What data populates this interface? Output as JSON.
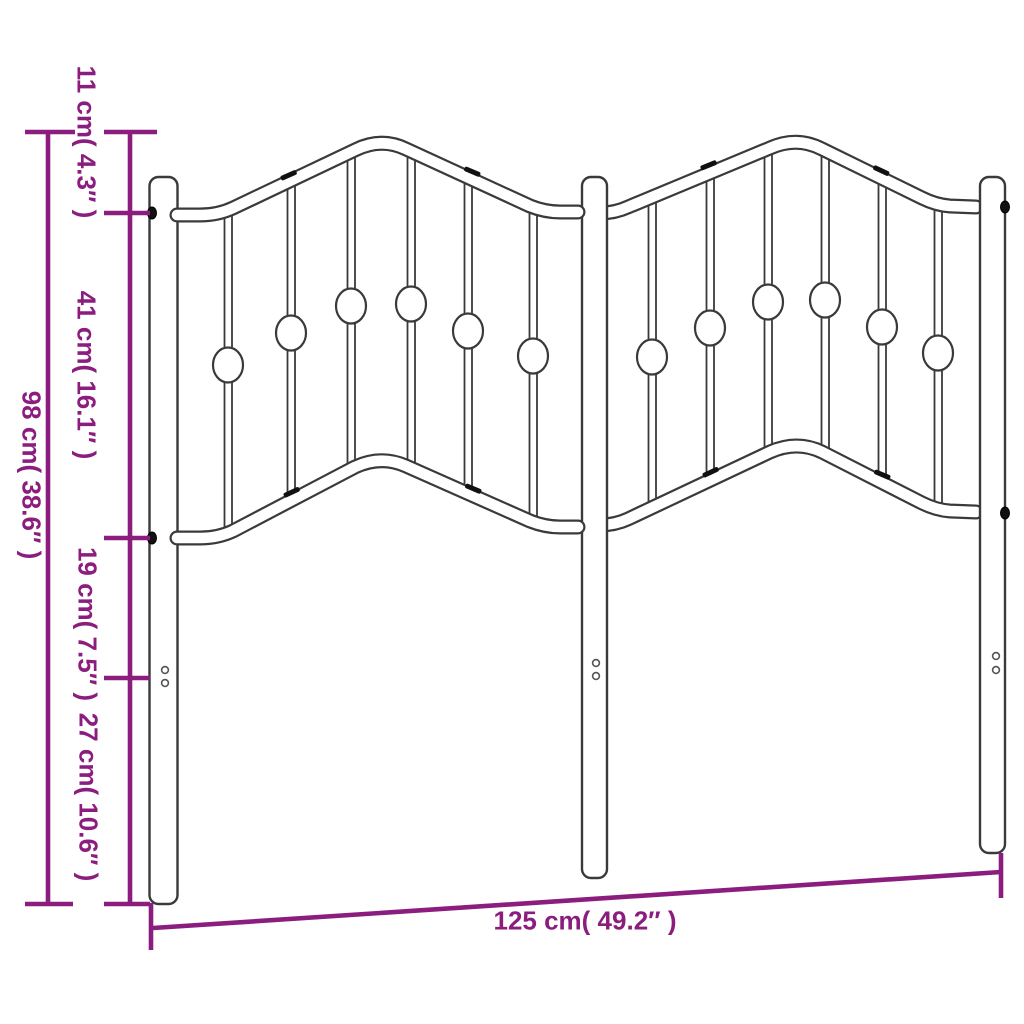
{
  "diagram": {
    "title": "Metal headboard dimension diagram",
    "accent_color": "#8b1d7e",
    "outline_color": "#3a3a3a",
    "labels": {
      "overall_height": "98 cm( 38.6″ )",
      "top_section": "11 cm( 4.3″ )",
      "upper_panel": "41 cm( 16.1″ )",
      "gap_below_panel": "19 cm( 7.5″ )",
      "leg_bottom": "27 cm( 10.6″ )",
      "overall_width": "125 cm( 49.2″ )"
    },
    "measurements": {
      "overall_height_cm": 98,
      "overall_height_in": 38.6,
      "top_section_cm": 11,
      "top_section_in": 4.3,
      "upper_panel_cm": 41,
      "upper_panel_in": 16.1,
      "gap_below_panel_cm": 19,
      "gap_below_panel_in": 7.5,
      "leg_bottom_cm": 27,
      "leg_bottom_in": 10.6,
      "overall_width_cm": 125,
      "overall_width_in": 49.2
    }
  }
}
